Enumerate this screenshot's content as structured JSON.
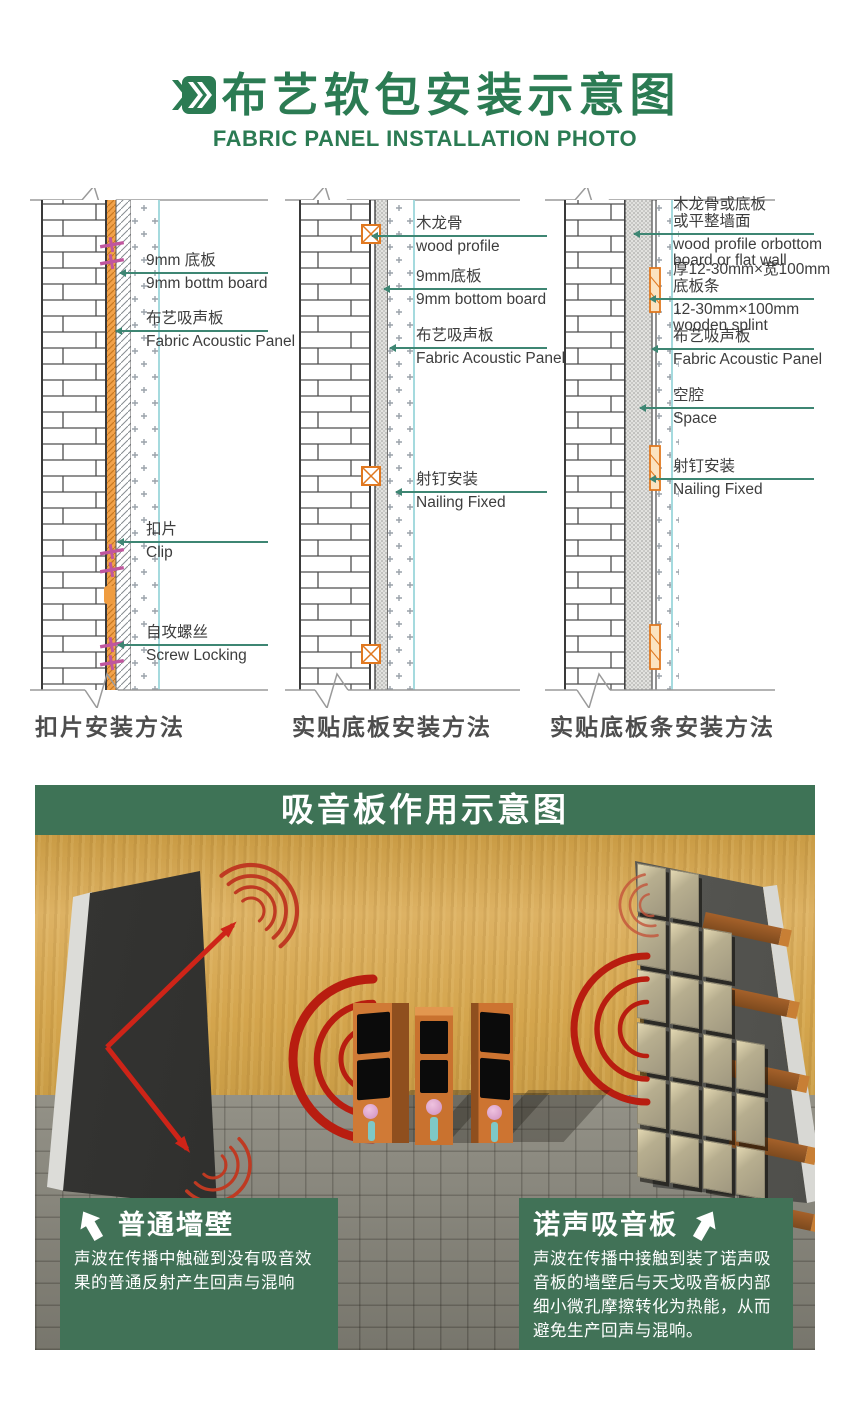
{
  "header": {
    "icon": "double-chevron-icon",
    "title_zh": "布艺软包安装示意图",
    "title_en": "FABRIC PANEL INSTALLATION PHOTO"
  },
  "diagrams": [
    {
      "caption": "扣片安装方法",
      "labels": [
        {
          "zh": "9mm 底板",
          "en": "9mm bottm board"
        },
        {
          "zh": "布艺吸声板",
          "en": "Fabric Acoustic Panel"
        },
        {
          "zh": "扣片",
          "en": "Clip"
        },
        {
          "zh": "自攻螺丝",
          "en": "Screw Locking"
        }
      ]
    },
    {
      "caption": "实贴底板安装方法",
      "labels": [
        {
          "zh": "木龙骨",
          "en": "wood profile"
        },
        {
          "zh": "9mm底板",
          "en": "9mm bottom board"
        },
        {
          "zh": "布艺吸声板",
          "en": "Fabric Acoustic Panel"
        },
        {
          "zh": "射钉安装",
          "en": "Nailing Fixed"
        }
      ]
    },
    {
      "caption": "实贴底板条安装方法",
      "labels": [
        {
          "zh1": "木龙骨或底板",
          "zh2": "或平整墙面",
          "en1": "wood profile orbottom",
          "en2": "board or flat wall"
        },
        {
          "zh1": "厚12-30mm×宽100mm",
          "zh2": "底板条",
          "en1": "12-30mm×100mm",
          "en2": "wooden splint"
        },
        {
          "zh1": "布艺吸声板",
          "en1": "Fabric Acoustic Panel"
        },
        {
          "zh1": "空腔",
          "en1": "Space"
        },
        {
          "zh1": "射钉安装",
          "en1": "Nailing Fixed"
        }
      ]
    }
  ],
  "scene": {
    "header": "吸音板作用示意图",
    "left_box": {
      "arrow_icon": "up-left-arrow-icon",
      "title": "普通墙壁",
      "body": "声波在传播中触碰到没有吸音效果的普通反射产生回声与混响"
    },
    "right_box": {
      "arrow_icon": "up-right-arrow-icon",
      "title": "诺声吸音板",
      "body": "声波在传播中接触到装了诺声吸音板的墙壁后与天戈吸音板内部细小微孔摩擦转化为热能，从而避免生产回声与混响。"
    }
  },
  "colors": {
    "brand_green": "#2b7b53",
    "leader_line": "#3e8673",
    "band_green": "#3e7356",
    "sound_red": "#c42318",
    "wood": "#d4a54d",
    "speaker_orange": "#c9722f",
    "clip_magenta": "#c0569e",
    "wood_profile_orange": "#e8963c"
  }
}
